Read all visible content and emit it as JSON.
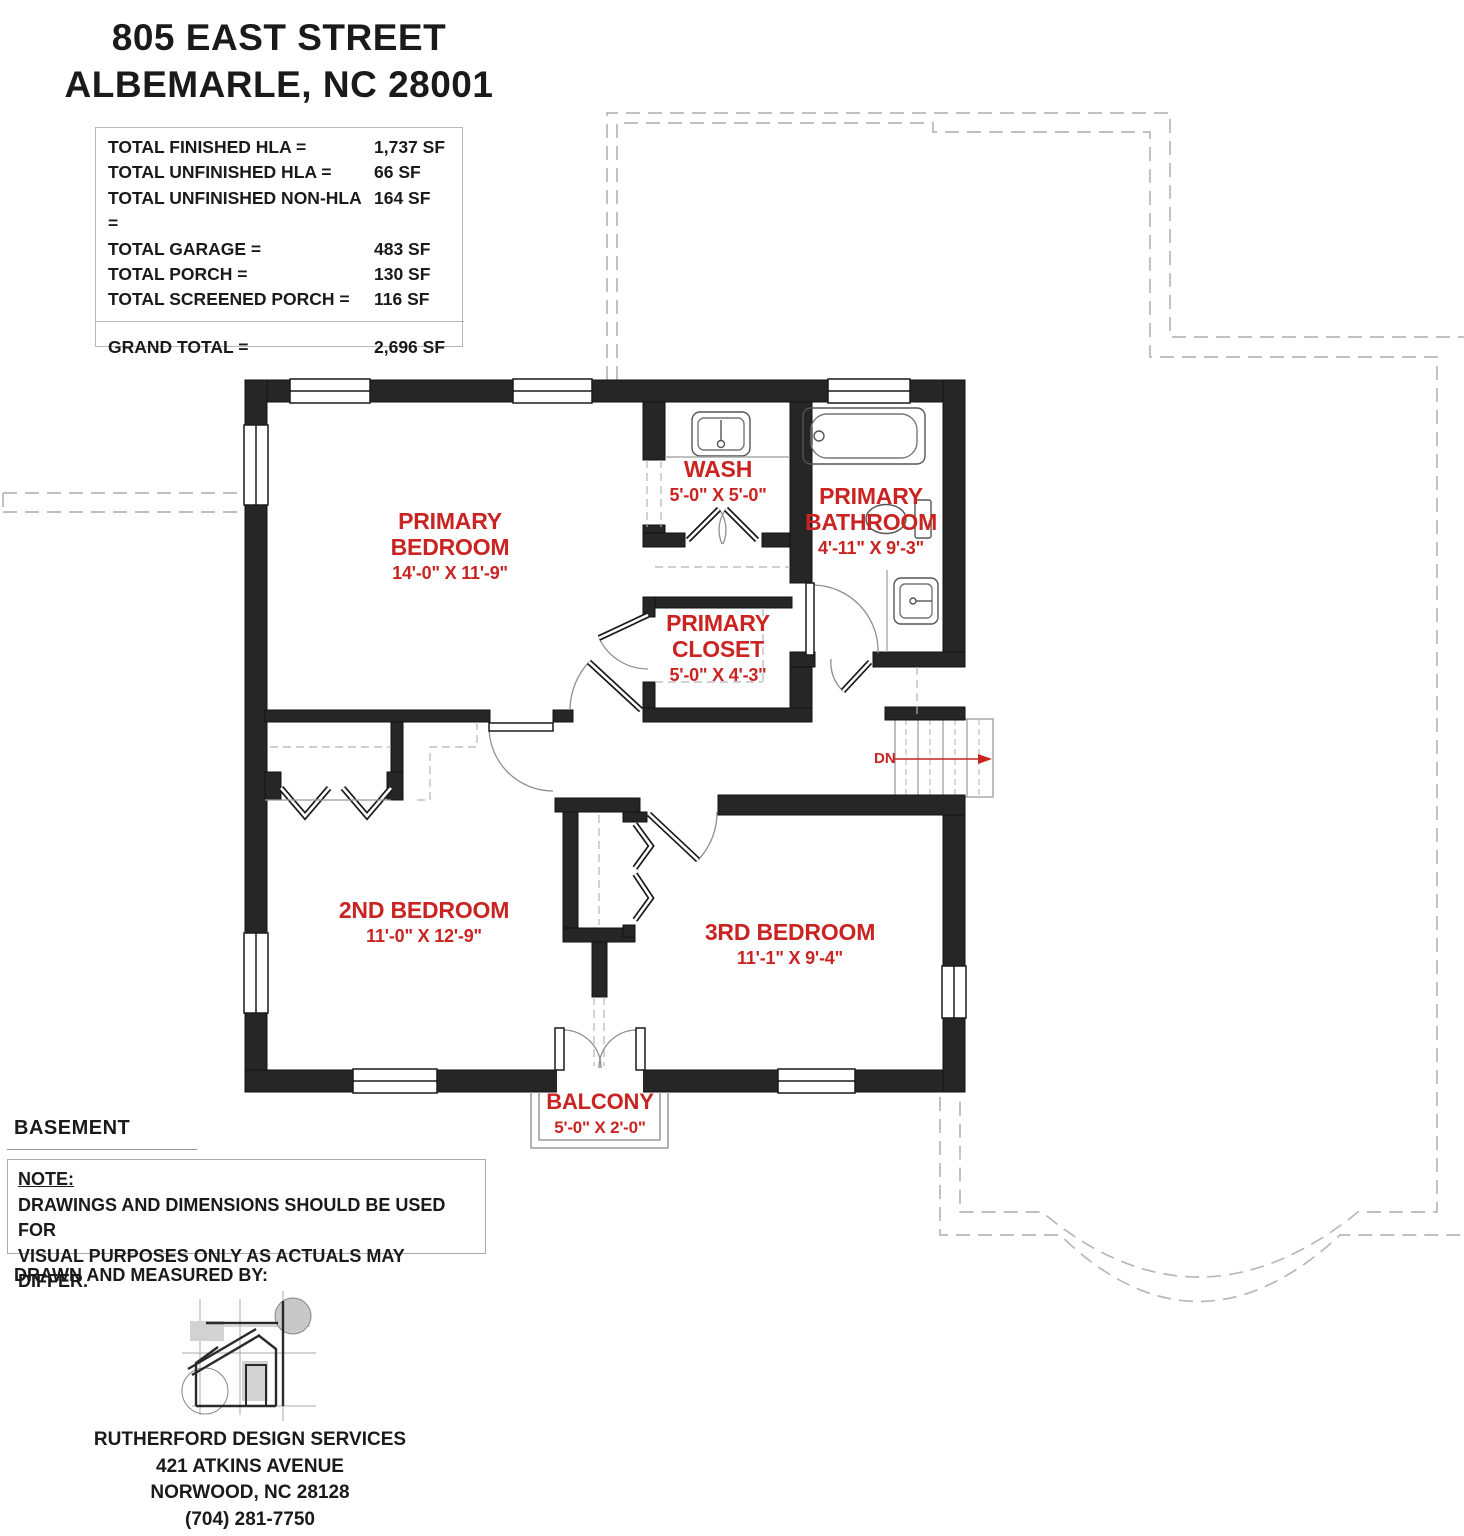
{
  "header": {
    "address_line1": "805 EAST STREET",
    "address_line2": "ALBEMARLE, NC 28001"
  },
  "area_table": {
    "rows": [
      {
        "label": "TOTAL FINISHED HLA =",
        "value": "1,737 SF"
      },
      {
        "label": "TOTAL UNFINISHED HLA =",
        "value": "66 SF"
      },
      {
        "label": "TOTAL UNFINISHED NON-HLA =",
        "value": "164 SF"
      },
      {
        "label": "TOTAL GARAGE =",
        "value": "483 SF"
      },
      {
        "label": "TOTAL PORCH =",
        "value": "130 SF"
      },
      {
        "label": "TOTAL SCREENED PORCH =",
        "value": "116 SF"
      }
    ],
    "grand_total": {
      "label": "GRAND TOTAL =",
      "value": "2,696 SF"
    }
  },
  "floor_label": "BASEMENT",
  "rooms": {
    "primary_bedroom": {
      "line1": "PRIMARY",
      "line2": "BEDROOM",
      "dims": "14'-0\" X 11'-9\""
    },
    "wash": {
      "name": "WASH",
      "dims": "5'-0\" X 5'-0\""
    },
    "primary_bathroom": {
      "line1": "PRIMARY",
      "line2": "BATHROOM",
      "dims": "4'-11\" X 9'-3\""
    },
    "primary_closet": {
      "line1": "PRIMARY",
      "line2": "CLOSET",
      "dims": "5'-0\" X 4'-3\""
    },
    "second_bedroom": {
      "name": "2ND BEDROOM",
      "dims": "11'-0\" X 12'-9\""
    },
    "third_bedroom": {
      "name": "3RD BEDROOM",
      "dims": "11'-1\" X 9'-4\""
    },
    "balcony": {
      "name": "BALCONY",
      "dims": "5'-0\" X 2'-0\""
    }
  },
  "stairs": {
    "label": "DN"
  },
  "note": {
    "heading": "NOTE:",
    "line1": "DRAWINGS AND DIMENSIONS SHOULD BE USED FOR",
    "line2": "VISUAL PURPOSES ONLY AS ACTUALS MAY DIFFER."
  },
  "drawn_by_label": "DRAWN AND MEASURED BY:",
  "designer": {
    "name": "RUTHERFORD DESIGN SERVICES",
    "address1": "421 ATKINS AVENUE",
    "address2": "NORWOOD, NC 28128",
    "phone": "(704) 281-7750"
  },
  "colors": {
    "accent_red": "#c92421",
    "wall_black": "#262626",
    "dashed_gray": "#b8b8b8"
  }
}
